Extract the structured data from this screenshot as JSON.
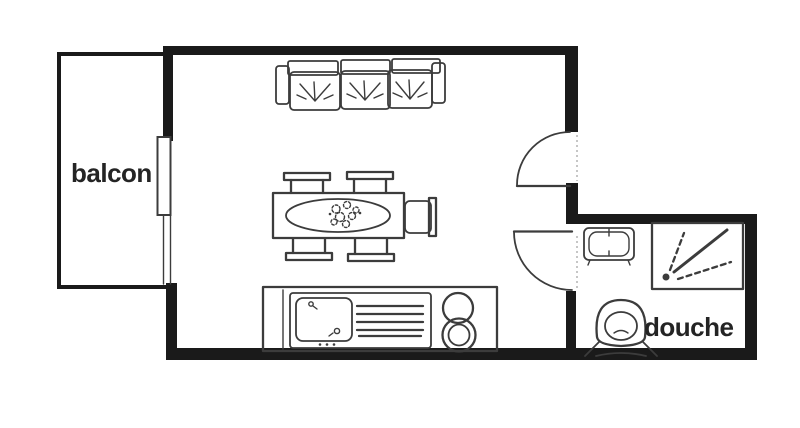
{
  "colors": {
    "background": "#ffffff",
    "wall": "#1a1a1a",
    "line": "#3c3c3c",
    "text": "#242424"
  },
  "labels": {
    "balcony": "balcon",
    "shower_room": "douche"
  },
  "symbols": [
    "sofa",
    "dining-table",
    "dining-chairs",
    "kitchen-counter",
    "kitchen-sink",
    "stove-burners",
    "washbasin",
    "toilet",
    "shower",
    "entrance-door-swing",
    "bathroom-door-swing",
    "balcony-sliding-door"
  ]
}
